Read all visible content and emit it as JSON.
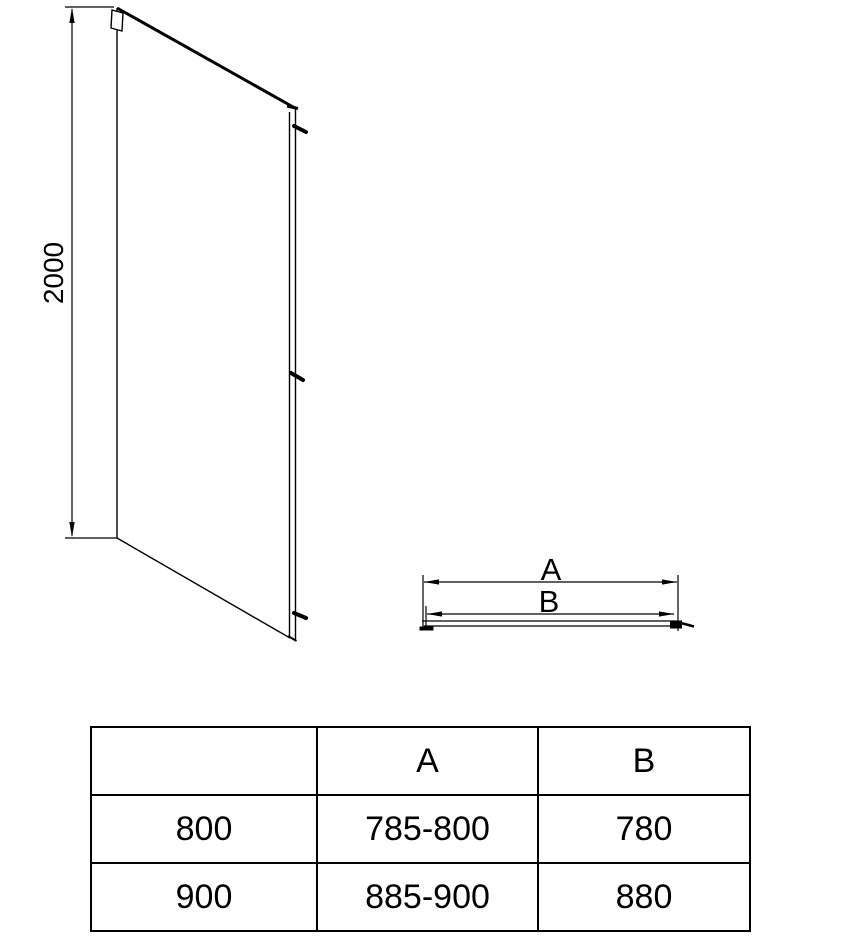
{
  "colors": {
    "line": "#000000",
    "background": "#ffffff",
    "text": "#000000"
  },
  "elevation": {
    "height_dim": "2000"
  },
  "plan": {
    "dim_a": "A",
    "dim_b": "B"
  },
  "table": {
    "headers": [
      "",
      "A",
      "B"
    ],
    "rows": [
      [
        "800",
        "785-800",
        "780"
      ],
      [
        "900",
        "885-900",
        "880"
      ]
    ]
  }
}
